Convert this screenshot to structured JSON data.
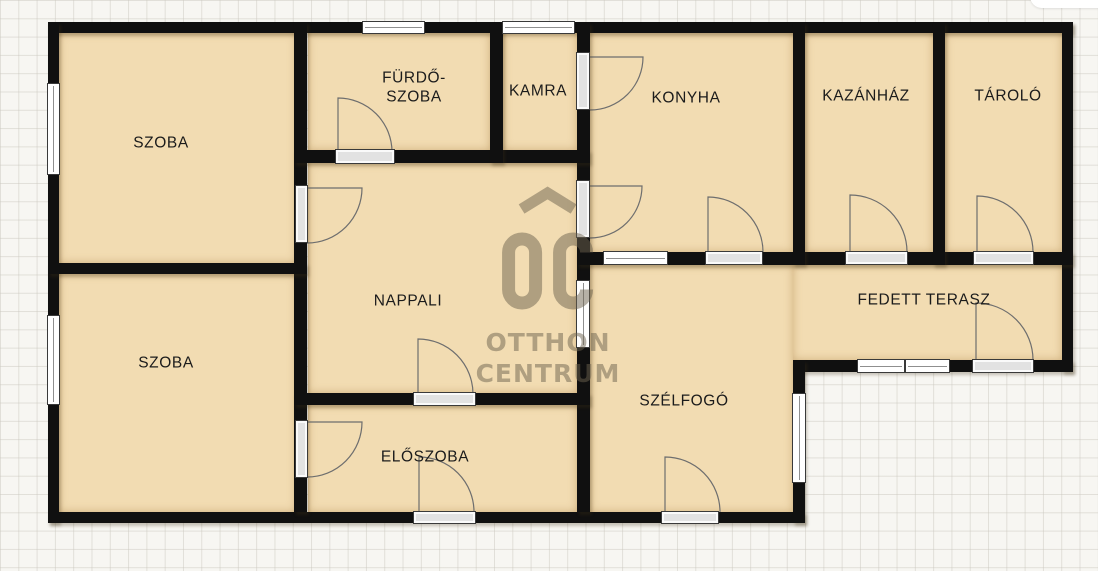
{
  "image": {
    "kind": "floor-plan",
    "language": "hu"
  },
  "colors": {
    "background": "#f7f6f2",
    "grid_line": "#cbc8bf",
    "wall": "#101010",
    "room_fill": "#f2dcb2",
    "label_text": "#1b1b1b",
    "window_fill": "#ffffff",
    "frame_stroke": "#3a3a3a",
    "door_fill": "#e2e2e2",
    "swing_stroke": "#6e6e6e",
    "watermark": "rgba(108,97,78,0.5)"
  },
  "watermark": {
    "monogram": "OC",
    "line1": "OTTHON",
    "line2": "CENTRUM"
  },
  "rooms": [
    {
      "id": "szoba-felso",
      "label": "SZOBA",
      "x": 59,
      "y": 33,
      "w": 237,
      "h": 230,
      "lx": 161,
      "ly": 143
    },
    {
      "id": "szoba-also",
      "label": "SZOBA",
      "x": 59,
      "y": 274,
      "w": 237,
      "h": 238,
      "lx": 166,
      "ly": 363
    },
    {
      "id": "furdoszoba",
      "label": "FÜRDŐ-\nSZOBA",
      "x": 308,
      "y": 33,
      "w": 182,
      "h": 117,
      "lx": 414,
      "ly": 88
    },
    {
      "id": "kamra",
      "label": "KAMRA",
      "x": 503,
      "y": 33,
      "w": 74,
      "h": 117,
      "lx": 538,
      "ly": 91
    },
    {
      "id": "konyha",
      "label": "KONYHA",
      "x": 590,
      "y": 33,
      "w": 203,
      "h": 219,
      "lx": 686,
      "ly": 98
    },
    {
      "id": "kazanhaz",
      "label": "KAZÁNHÁZ",
      "x": 805,
      "y": 33,
      "w": 128,
      "h": 219,
      "lx": 866,
      "ly": 96
    },
    {
      "id": "tarolo",
      "label": "TÁROLÓ",
      "x": 945,
      "y": 33,
      "w": 117,
      "h": 219,
      "lx": 1008,
      "ly": 96
    },
    {
      "id": "nappali",
      "label": "NAPPALI",
      "x": 308,
      "y": 163,
      "w": 269,
      "h": 230,
      "lx": 408,
      "ly": 301
    },
    {
      "id": "eloszoba",
      "label": "ELŐSZOBA",
      "x": 308,
      "y": 405,
      "w": 269,
      "h": 107,
      "lx": 425,
      "ly": 457
    },
    {
      "id": "szelfogo",
      "label": "SZÉLFOGÓ",
      "x": 590,
      "y": 265,
      "w": 203,
      "h": 247,
      "lx": 684,
      "ly": 401
    },
    {
      "id": "fedett-terasz",
      "label": "FEDETT TERASZ",
      "x": 793,
      "y": 265,
      "w": 269,
      "h": 95,
      "lx": 924,
      "ly": 300
    }
  ],
  "walls": [
    {
      "id": "top",
      "x": 48,
      "y": 22,
      "w": 1025,
      "h": 11
    },
    {
      "id": "left",
      "x": 48,
      "y": 22,
      "w": 11,
      "h": 501
    },
    {
      "id": "right",
      "x": 1062,
      "y": 22,
      "w": 11,
      "h": 350
    },
    {
      "id": "bottom",
      "x": 48,
      "y": 512,
      "w": 757,
      "h": 11
    },
    {
      "id": "terasz-bottom",
      "x": 793,
      "y": 360,
      "w": 280,
      "h": 12
    },
    {
      "id": "szelfogo-right",
      "x": 793,
      "y": 360,
      "w": 12,
      "h": 163
    },
    {
      "id": "center-vertical",
      "x": 577,
      "y": 22,
      "w": 13,
      "h": 490
    },
    {
      "id": "szoba-vertical",
      "x": 294,
      "y": 22,
      "w": 13,
      "h": 490
    },
    {
      "id": "furdo-bottom",
      "x": 294,
      "y": 150,
      "w": 296,
      "h": 13
    },
    {
      "id": "furdo-kamra",
      "x": 490,
      "y": 22,
      "w": 13,
      "h": 141
    },
    {
      "id": "szoba-divider",
      "x": 48,
      "y": 263,
      "w": 259,
      "h": 11
    },
    {
      "id": "nappali-bottom",
      "x": 294,
      "y": 393,
      "w": 296,
      "h": 12
    },
    {
      "id": "konyha-bottom",
      "x": 577,
      "y": 252,
      "w": 496,
      "h": 13
    },
    {
      "id": "konyha-kazanhaz",
      "x": 793,
      "y": 22,
      "w": 12,
      "h": 243
    },
    {
      "id": "kazanhaz-tarolo",
      "x": 933,
      "y": 22,
      "w": 12,
      "h": 243
    }
  ],
  "windows": [
    {
      "id": "window-szoba-felso-west",
      "x": 47,
      "y": 83,
      "w": 13,
      "h": 92,
      "dir": "v"
    },
    {
      "id": "window-szoba-also-west",
      "x": 47,
      "y": 315,
      "w": 13,
      "h": 90,
      "dir": "v"
    },
    {
      "id": "window-furdoszoba-north",
      "x": 362,
      "y": 21,
      "w": 63,
      "h": 13,
      "dir": "h"
    },
    {
      "id": "window-kamra-north",
      "x": 502,
      "y": 21,
      "w": 73,
      "h": 13,
      "dir": "h"
    },
    {
      "id": "window-szelfogo-north",
      "x": 603,
      "y": 251,
      "w": 65,
      "h": 14,
      "dir": "h"
    },
    {
      "id": "window-nappali-szelfogo",
      "x": 576,
      "y": 280,
      "w": 14,
      "h": 68,
      "dir": "v"
    },
    {
      "id": "window-szelfogo-east",
      "x": 792,
      "y": 393,
      "w": 14,
      "h": 90,
      "dir": "v"
    },
    {
      "id": "window-terasz-1",
      "x": 857,
      "y": 359,
      "w": 48,
      "h": 14,
      "dir": "h"
    },
    {
      "id": "window-terasz-2",
      "x": 905,
      "y": 359,
      "w": 45,
      "h": 14,
      "dir": "h"
    }
  ],
  "doors": [
    {
      "id": "door-kamra-konyha",
      "sx": 576,
      "sy": 52,
      "sw": 14,
      "sh": 58,
      "hx": 590,
      "hy": 57,
      "r": 53,
      "a0": 0,
      "a1": 90
    },
    {
      "id": "door-nappali-konyha",
      "sx": 576,
      "sy": 180,
      "sw": 14,
      "sh": 58,
      "hx": 590,
      "hy": 186,
      "r": 52,
      "a0": 0,
      "a1": 90
    },
    {
      "id": "door-szoba-felso-nappali",
      "sx": 295,
      "sy": 185,
      "sw": 13,
      "sh": 58,
      "hx": 307,
      "hy": 188,
      "r": 55,
      "a0": 0,
      "a1": 90
    },
    {
      "id": "door-szoba-also-eloszoba",
      "sx": 295,
      "sy": 420,
      "sw": 13,
      "sh": 58,
      "hx": 307,
      "hy": 422,
      "r": 55,
      "a0": 0,
      "a1": 90
    },
    {
      "id": "door-furdoszoba",
      "sx": 335,
      "sy": 149,
      "sw": 60,
      "sh": 15,
      "hx": 338,
      "hy": 152,
      "r": 54,
      "a0": -90,
      "a1": 0
    },
    {
      "id": "door-nappali-eloszoba",
      "sx": 413,
      "sy": 392,
      "sw": 63,
      "sh": 14,
      "hx": 418,
      "hy": 394,
      "r": 55,
      "a0": -90,
      "a1": 0
    },
    {
      "id": "door-bejarat-eloszoba",
      "sx": 413,
      "sy": 511,
      "sw": 63,
      "sh": 13,
      "hx": 419,
      "hy": 512,
      "r": 55,
      "a0": -90,
      "a1": 0
    },
    {
      "id": "door-konyha",
      "sx": 705,
      "sy": 251,
      "sw": 58,
      "sh": 14,
      "hx": 708,
      "hy": 252,
      "r": 55,
      "a0": -90,
      "a1": 0
    },
    {
      "id": "door-kazanhaz",
      "sx": 845,
      "sy": 251,
      "sw": 63,
      "sh": 14,
      "hx": 850,
      "hy": 252,
      "r": 57,
      "a0": -90,
      "a1": 0
    },
    {
      "id": "door-tarolo",
      "sx": 973,
      "sy": 251,
      "sw": 61,
      "sh": 14,
      "hx": 977,
      "hy": 252,
      "r": 56,
      "a0": -90,
      "a1": 0
    },
    {
      "id": "door-bejarat-szelfogo",
      "sx": 661,
      "sy": 511,
      "sw": 58,
      "sh": 13,
      "hx": 665,
      "hy": 512,
      "r": 55,
      "a0": -90,
      "a1": 0
    },
    {
      "id": "door-terasz",
      "sx": 972,
      "sy": 359,
      "sw": 62,
      "sh": 14,
      "hx": 976,
      "hy": 360,
      "r": 57,
      "a0": -90,
      "a1": 0
    }
  ]
}
